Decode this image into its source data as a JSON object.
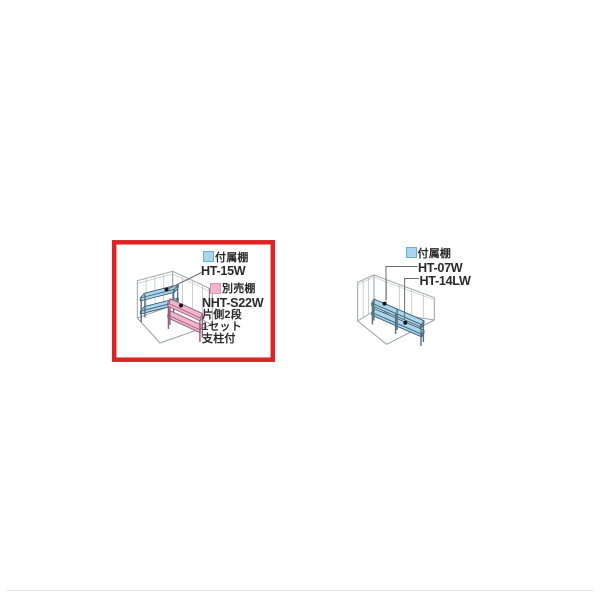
{
  "page": {
    "background": "#ffffff"
  },
  "colors": {
    "highlight_red": "#dc2428",
    "shelf_blue": "#aad6ec",
    "shelf_pink": "#f2b4cc",
    "shelf_outline": "#3b5a70",
    "line_gray": "#9aa0a6",
    "text": "#2b2b2b",
    "swatch_blue_border": "#6aaed2",
    "swatch_pink_border": "#dd93b4"
  },
  "left_diagram": {
    "highlighted": true,
    "included_legend_label": "付属棚",
    "included_model": "HT-15W",
    "optional_legend_label": "別売棚",
    "optional_model": "NHT-S22W",
    "optional_specs": [
      "片側2段",
      "1セット",
      "支柱付"
    ]
  },
  "right_diagram": {
    "included_legend_label": "付属棚",
    "models": [
      "HT-07W",
      "HT-14LW"
    ]
  }
}
